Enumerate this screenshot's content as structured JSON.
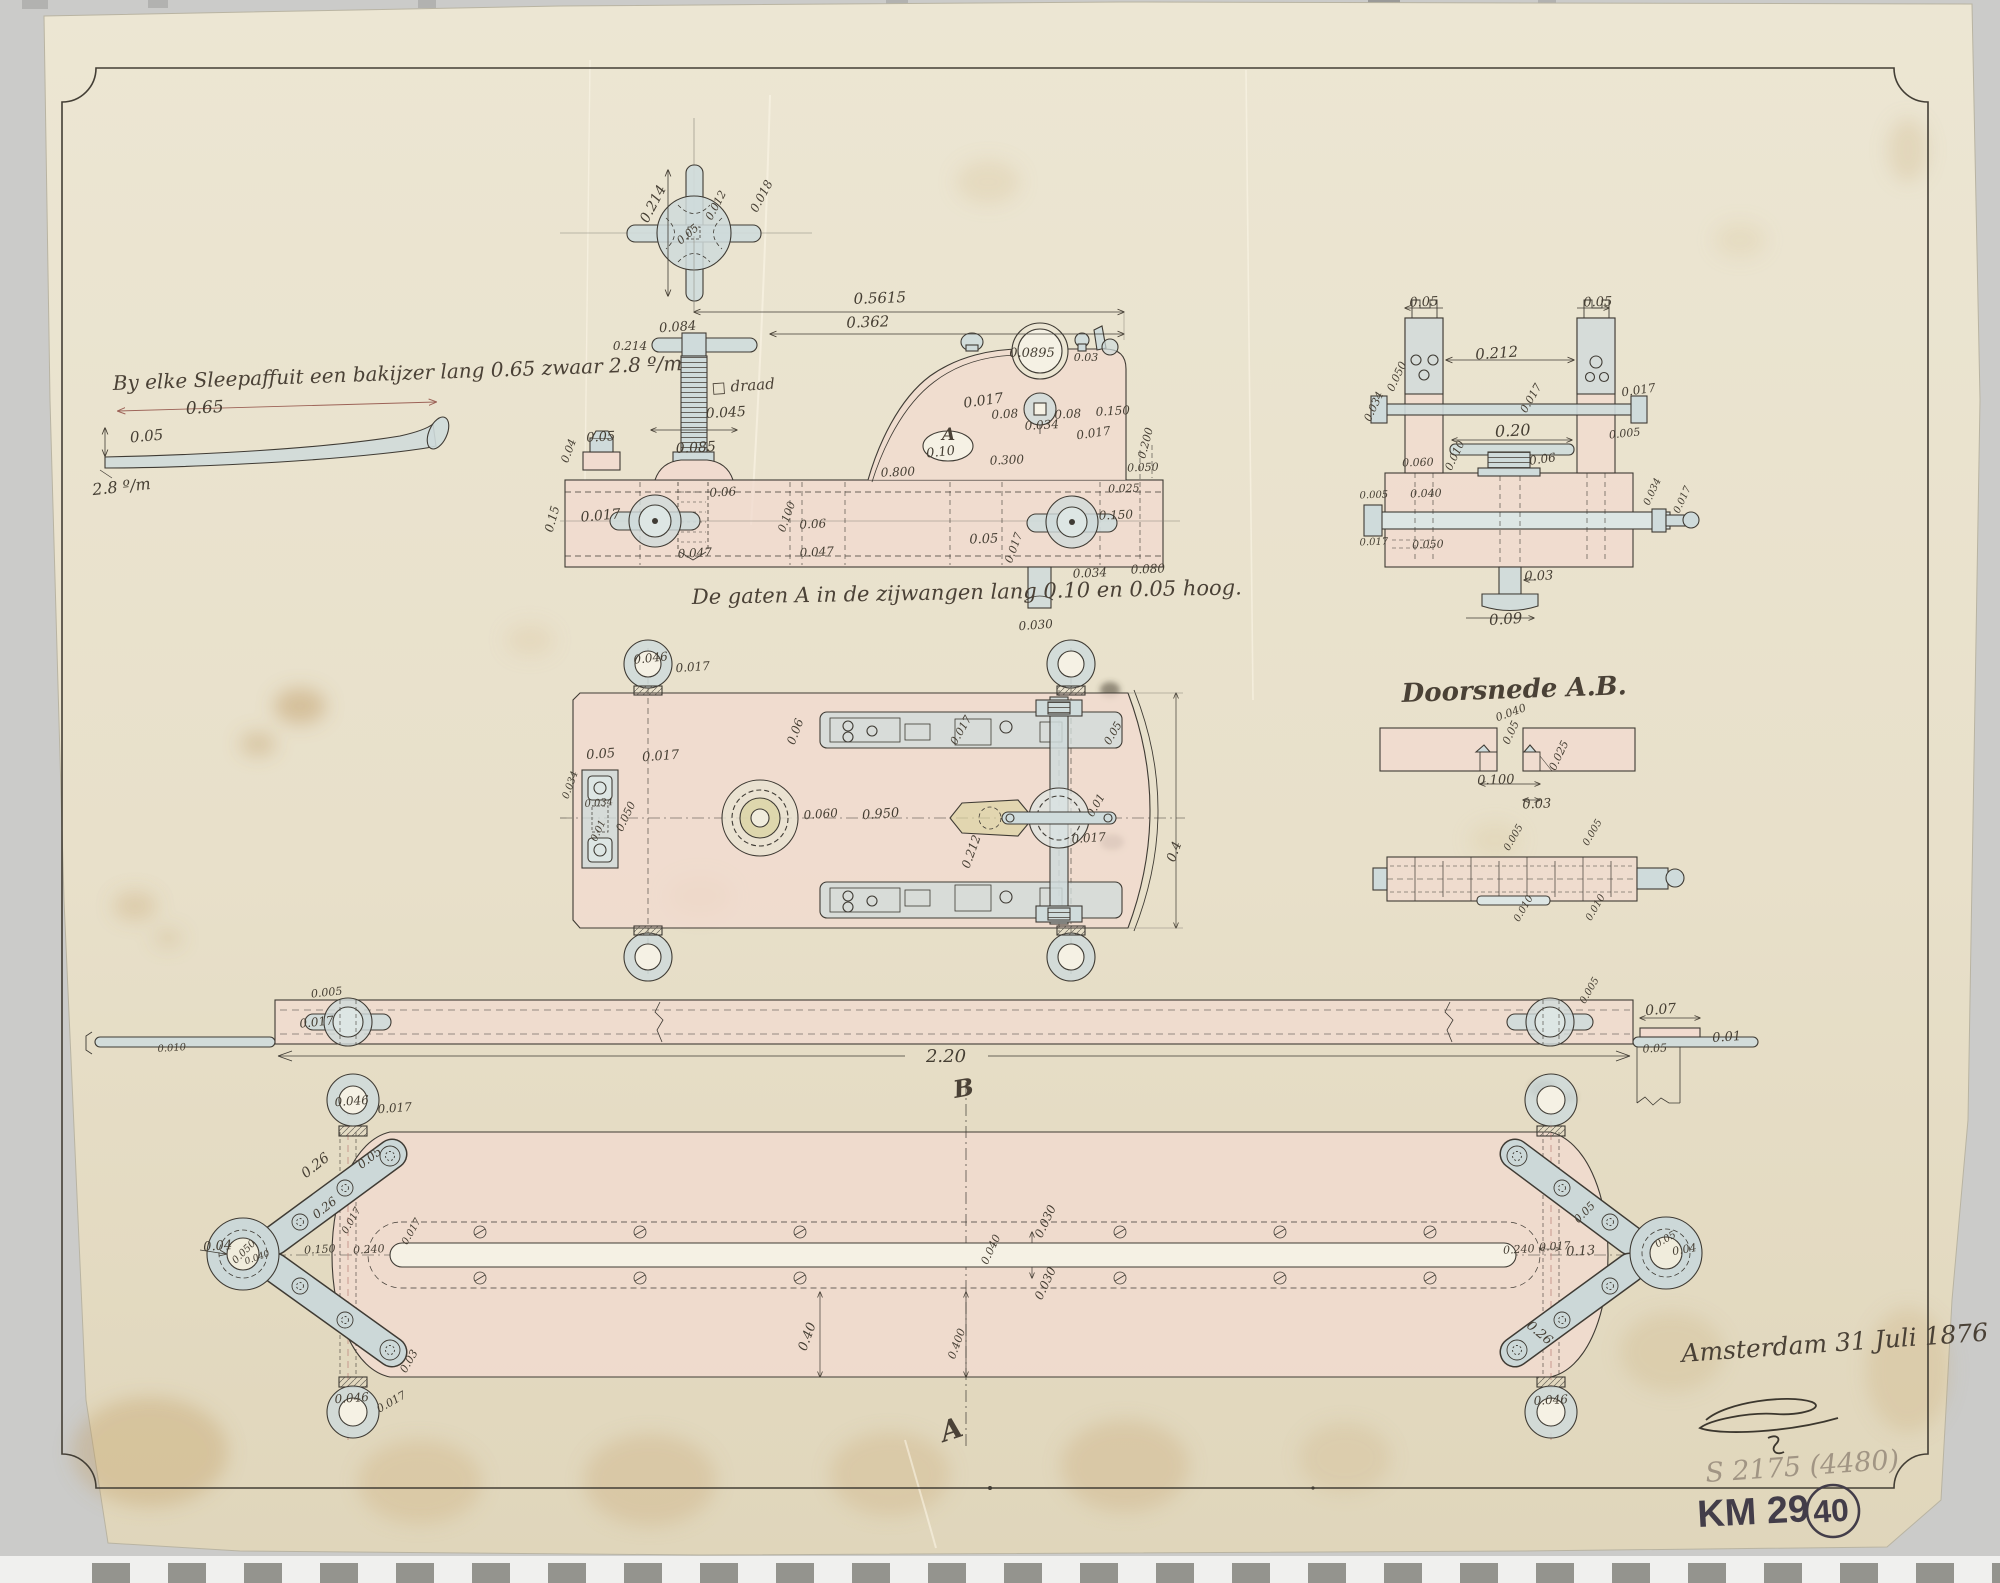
{
  "document": {
    "note_topleft": "By elke Sleepaffuit een bakijzer lang 0.65 zwaar 2.8 º/m",
    "caption_holes": "De gaten A in de zijwangen lang 0.10 en 0.05 hoog.",
    "section_title": "Doorsnede A.B.",
    "date_signature": "Amsterdam 31 Juli 1876",
    "inventory_pencil": "S 2175 (4480)",
    "archive_code": "KM 29",
    "sheet_number": "40",
    "section_marker_top": "B",
    "section_marker_bottom": "A",
    "hole_label": "A",
    "thread_note": "□ draad"
  },
  "colors": {
    "paper": "#e9e2cd",
    "backdrop": "#cbcbc9",
    "ink": "#3f3b34",
    "pink_wash": "#f1dbcf",
    "blue_wash": "#cfdbdb",
    "brass_wash": "#dbd3a4",
    "pencil": "#a19584",
    "felt_marker": "#433d49",
    "red_dim": "#9c6257"
  },
  "annotations": [
    {
      "t": "0.65",
      "x": 205,
      "y": 413,
      "r": -3,
      "s": 17
    },
    {
      "t": "0.05",
      "x": 147,
      "y": 441,
      "r": -5,
      "s": 15
    },
    {
      "t": "2.8 º/m",
      "x": 122,
      "y": 492,
      "r": -6,
      "s": 16
    },
    {
      "t": "0.214",
      "x": 657,
      "y": 206,
      "r": -62,
      "s": 14
    },
    {
      "t": "0.05",
      "x": 690,
      "y": 237,
      "r": -40,
      "s": 11
    },
    {
      "t": "0.012",
      "x": 719,
      "y": 207,
      "r": -62,
      "s": 11
    },
    {
      "t": "0.018",
      "x": 765,
      "y": 198,
      "r": -62,
      "s": 12
    },
    {
      "t": "0.084",
      "x": 678,
      "y": 331,
      "r": -4,
      "s": 13
    },
    {
      "t": "0.214",
      "x": 630,
      "y": 350,
      "r": 0,
      "s": 12
    },
    {
      "t": "0.045",
      "x": 726,
      "y": 417,
      "r": -3,
      "s": 14
    },
    {
      "t": "0.085",
      "x": 696,
      "y": 452,
      "r": -3,
      "s": 14
    },
    {
      "t": "0.05",
      "x": 601,
      "y": 441,
      "r": -3,
      "s": 13
    },
    {
      "t": "0.04",
      "x": 572,
      "y": 452,
      "r": -70,
      "s": 11
    },
    {
      "t": "0.017",
      "x": 601,
      "y": 520,
      "r": -5,
      "s": 14
    },
    {
      "t": "0.06",
      "x": 723,
      "y": 496,
      "r": -3,
      "s": 12
    },
    {
      "t": "0.100",
      "x": 790,
      "y": 518,
      "r": -70,
      "s": 11
    },
    {
      "t": "0.06",
      "x": 813,
      "y": 528,
      "r": -3,
      "s": 12
    },
    {
      "t": "0.047",
      "x": 695,
      "y": 557,
      "r": -3,
      "s": 12
    },
    {
      "t": "0.047",
      "x": 817,
      "y": 556,
      "r": -3,
      "s": 12
    },
    {
      "t": "0.15",
      "x": 556,
      "y": 520,
      "r": -75,
      "s": 12
    },
    {
      "t": "0.5615",
      "x": 880,
      "y": 303,
      "r": -2,
      "s": 15
    },
    {
      "t": "0.362",
      "x": 868,
      "y": 327,
      "r": -2,
      "s": 15
    },
    {
      "t": "0.0895",
      "x": 1032,
      "y": 357,
      "r": 0,
      "s": 13
    },
    {
      "t": "0.03",
      "x": 1086,
      "y": 361,
      "r": 0,
      "s": 11
    },
    {
      "t": "0.017",
      "x": 984,
      "y": 405,
      "r": -8,
      "s": 14
    },
    {
      "t": "0.08",
      "x": 1005,
      "y": 418,
      "r": -3,
      "s": 12
    },
    {
      "t": "0.034",
      "x": 1042,
      "y": 429,
      "r": -3,
      "s": 12
    },
    {
      "t": "0.08",
      "x": 1068,
      "y": 418,
      "r": -3,
      "s": 12
    },
    {
      "t": "0.150",
      "x": 1113,
      "y": 415,
      "r": -3,
      "s": 12
    },
    {
      "t": "0.017",
      "x": 1094,
      "y": 437,
      "r": -8,
      "s": 12
    },
    {
      "t": "0.200",
      "x": 1149,
      "y": 444,
      "r": -75,
      "s": 11
    },
    {
      "t": "0.10",
      "x": 941,
      "y": 456,
      "r": -6,
      "s": 13
    },
    {
      "t": "0.300",
      "x": 1007,
      "y": 464,
      "r": -2,
      "s": 12
    },
    {
      "t": "0.800",
      "x": 898,
      "y": 476,
      "r": -2,
      "s": 12
    },
    {
      "t": "0.050",
      "x": 1143,
      "y": 471,
      "r": -2,
      "s": 11
    },
    {
      "t": "0.025",
      "x": 1124,
      "y": 492,
      "r": -2,
      "s": 11
    },
    {
      "t": "0.150",
      "x": 1116,
      "y": 519,
      "r": -2,
      "s": 12
    },
    {
      "t": "0.05",
      "x": 984,
      "y": 543,
      "r": -2,
      "s": 13
    },
    {
      "t": "0.017",
      "x": 1017,
      "y": 549,
      "r": -70,
      "s": 11
    },
    {
      "t": "0.034",
      "x": 1090,
      "y": 577,
      "r": -2,
      "s": 12
    },
    {
      "t": "0.080",
      "x": 1148,
      "y": 573,
      "r": -2,
      "s": 12
    },
    {
      "t": "0.030",
      "x": 1036,
      "y": 629,
      "r": -4,
      "s": 12
    },
    {
      "t": "0.05",
      "x": 1424,
      "y": 306,
      "r": -2,
      "s": 13
    },
    {
      "t": "0.05",
      "x": 1598,
      "y": 306,
      "r": -2,
      "s": 13
    },
    {
      "t": "0.212",
      "x": 1497,
      "y": 358,
      "r": -4,
      "s": 15
    },
    {
      "t": "0.017",
      "x": 1534,
      "y": 400,
      "r": -60,
      "s": 11
    },
    {
      "t": "0.017",
      "x": 1639,
      "y": 394,
      "r": -8,
      "s": 12
    },
    {
      "t": "0.034",
      "x": 1377,
      "y": 408,
      "r": -65,
      "s": 11
    },
    {
      "t": "0.050",
      "x": 1400,
      "y": 378,
      "r": -65,
      "s": 11
    },
    {
      "t": "0.20",
      "x": 1513,
      "y": 436,
      "r": -3,
      "s": 16
    },
    {
      "t": "0.010",
      "x": 1458,
      "y": 457,
      "r": -65,
      "s": 11
    },
    {
      "t": "0.06",
      "x": 1543,
      "y": 463,
      "r": -8,
      "s": 12
    },
    {
      "t": "0.005",
      "x": 1625,
      "y": 437,
      "r": -6,
      "s": 11
    },
    {
      "t": "0.060",
      "x": 1418,
      "y": 466,
      "r": -2,
      "s": 11
    },
    {
      "t": "0.040",
      "x": 1426,
      "y": 497,
      "r": -2,
      "s": 11
    },
    {
      "t": "0.005",
      "x": 1374,
      "y": 498,
      "r": -2,
      "s": 10
    },
    {
      "t": "0.050",
      "x": 1428,
      "y": 548,
      "r": -2,
      "s": 11
    },
    {
      "t": "0.017",
      "x": 1374,
      "y": 545,
      "r": -2,
      "s": 10
    },
    {
      "t": "0.034",
      "x": 1655,
      "y": 493,
      "r": -65,
      "s": 10
    },
    {
      "t": "0.017",
      "x": 1685,
      "y": 501,
      "r": -65,
      "s": 10
    },
    {
      "t": "0.03",
      "x": 1539,
      "y": 580,
      "r": -2,
      "s": 13
    },
    {
      "t": "0.09",
      "x": 1506,
      "y": 624,
      "r": -4,
      "s": 15
    },
    {
      "t": "0.040",
      "x": 1512,
      "y": 716,
      "r": -20,
      "s": 11
    },
    {
      "t": "0.05",
      "x": 1514,
      "y": 734,
      "r": -65,
      "s": 11
    },
    {
      "t": "0.025",
      "x": 1562,
      "y": 757,
      "r": -65,
      "s": 11
    },
    {
      "t": "0.100",
      "x": 1496,
      "y": 784,
      "r": -2,
      "s": 13
    },
    {
      "t": "0.03",
      "x": 1537,
      "y": 808,
      "r": -2,
      "s": 13
    },
    {
      "t": "0.005",
      "x": 1516,
      "y": 839,
      "r": -60,
      "s": 10
    },
    {
      "t": "0.005",
      "x": 1595,
      "y": 834,
      "r": -60,
      "s": 10
    },
    {
      "t": "0.010",
      "x": 1526,
      "y": 910,
      "r": -60,
      "s": 10
    },
    {
      "t": "0.010",
      "x": 1598,
      "y": 909,
      "r": -60,
      "s": 10
    },
    {
      "t": "0.046",
      "x": 651,
      "y": 662,
      "r": -6,
      "s": 12
    },
    {
      "t": "0.017",
      "x": 693,
      "y": 671,
      "r": -4,
      "s": 12
    },
    {
      "t": "0.05",
      "x": 601,
      "y": 758,
      "r": -4,
      "s": 13
    },
    {
      "t": "0.017",
      "x": 661,
      "y": 760,
      "r": -4,
      "s": 13
    },
    {
      "t": "0.034",
      "x": 573,
      "y": 786,
      "r": -70,
      "s": 10
    },
    {
      "t": "0.034",
      "x": 599,
      "y": 806,
      "r": -4,
      "s": 10
    },
    {
      "t": "0.050",
      "x": 629,
      "y": 818,
      "r": -65,
      "s": 11
    },
    {
      "t": "0.01",
      "x": 601,
      "y": 832,
      "r": -65,
      "s": 10
    },
    {
      "t": "0.06",
      "x": 799,
      "y": 733,
      "r": -70,
      "s": 12
    },
    {
      "t": "0.060",
      "x": 821,
      "y": 818,
      "r": -4,
      "s": 12
    },
    {
      "t": "0.950",
      "x": 881,
      "y": 818,
      "r": -4,
      "s": 13
    },
    {
      "t": "0.017",
      "x": 964,
      "y": 732,
      "r": -60,
      "s": 11
    },
    {
      "t": "0.05",
      "x": 1116,
      "y": 735,
      "r": -60,
      "s": 11
    },
    {
      "t": "0.01",
      "x": 1099,
      "y": 807,
      "r": -60,
      "s": 11
    },
    {
      "t": "0.017",
      "x": 1089,
      "y": 842,
      "r": -4,
      "s": 12
    },
    {
      "t": "0.212",
      "x": 975,
      "y": 853,
      "r": -70,
      "s": 12
    },
    {
      "t": "0.4",
      "x": 1178,
      "y": 853,
      "r": -70,
      "s": 13
    },
    {
      "t": "0.005",
      "x": 327,
      "y": 996,
      "r": -6,
      "s": 11
    },
    {
      "t": "0.017",
      "x": 317,
      "y": 1026,
      "r": -6,
      "s": 12
    },
    {
      "t": "0.010",
      "x": 172,
      "y": 1051,
      "r": -4,
      "s": 10
    },
    {
      "t": "2.20",
      "x": 946,
      "y": 1062,
      "r": 0,
      "s": 18
    },
    {
      "t": "0.005",
      "x": 1592,
      "y": 992,
      "r": -60,
      "s": 10
    },
    {
      "t": "0.07",
      "x": 1661,
      "y": 1014,
      "r": -4,
      "s": 14
    },
    {
      "t": "0.01",
      "x": 1727,
      "y": 1041,
      "r": -4,
      "s": 13
    },
    {
      "t": "0.05",
      "x": 1655,
      "y": 1052,
      "r": -3,
      "s": 11
    },
    {
      "t": "0.046",
      "x": 352,
      "y": 1105,
      "r": -4,
      "s": 12
    },
    {
      "t": "0.017",
      "x": 395,
      "y": 1112,
      "r": -4,
      "s": 12
    },
    {
      "t": "0.26",
      "x": 318,
      "y": 1169,
      "r": -38,
      "s": 14
    },
    {
      "t": "0.05",
      "x": 372,
      "y": 1161,
      "r": -38,
      "s": 12
    },
    {
      "t": "0.26",
      "x": 327,
      "y": 1211,
      "r": -38,
      "s": 12
    },
    {
      "t": "0.017",
      "x": 354,
      "y": 1222,
      "r": -60,
      "s": 10
    },
    {
      "t": "0.04",
      "x": 218,
      "y": 1250,
      "r": -4,
      "s": 13
    },
    {
      "t": "0.050",
      "x": 246,
      "y": 1254,
      "r": -45,
      "s": 10
    },
    {
      "t": "0.040",
      "x": 258,
      "y": 1260,
      "r": -20,
      "s": 9
    },
    {
      "t": "0.150",
      "x": 320,
      "y": 1253,
      "r": -3,
      "s": 11
    },
    {
      "t": "0.240",
      "x": 369,
      "y": 1253,
      "r": -3,
      "s": 11
    },
    {
      "t": "0.017",
      "x": 414,
      "y": 1233,
      "r": -60,
      "s": 10
    },
    {
      "t": "0.03",
      "x": 412,
      "y": 1363,
      "r": -60,
      "s": 11
    },
    {
      "t": "0.046",
      "x": 352,
      "y": 1402,
      "r": -4,
      "s": 12
    },
    {
      "t": "0.017",
      "x": 393,
      "y": 1405,
      "r": -30,
      "s": 11
    },
    {
      "t": "0.030",
      "x": 1049,
      "y": 1223,
      "r": -65,
      "s": 12
    },
    {
      "t": "0.040",
      "x": 994,
      "y": 1251,
      "r": -65,
      "s": 11
    },
    {
      "t": "0.030",
      "x": 1049,
      "y": 1285,
      "r": -65,
      "s": 12
    },
    {
      "t": "0.40",
      "x": 811,
      "y": 1338,
      "r": -70,
      "s": 13
    },
    {
      "t": "0.400",
      "x": 960,
      "y": 1345,
      "r": -70,
      "s": 11
    },
    {
      "t": "0.240",
      "x": 1519,
      "y": 1253,
      "r": -3,
      "s": 11
    },
    {
      "t": "0.017",
      "x": 1555,
      "y": 1250,
      "r": -3,
      "s": 11
    },
    {
      "t": "0.13",
      "x": 1581,
      "y": 1255,
      "r": -3,
      "s": 13
    },
    {
      "t": "0.05",
      "x": 1587,
      "y": 1215,
      "r": -45,
      "s": 11
    },
    {
      "t": "0.05",
      "x": 1667,
      "y": 1242,
      "r": -30,
      "s": 10
    },
    {
      "t": "0.04",
      "x": 1685,
      "y": 1253,
      "r": -10,
      "s": 11
    },
    {
      "t": "0.26",
      "x": 1537,
      "y": 1336,
      "r": 40,
      "s": 13
    },
    {
      "t": "0.046",
      "x": 1551,
      "y": 1404,
      "r": -3,
      "s": 12
    }
  ]
}
